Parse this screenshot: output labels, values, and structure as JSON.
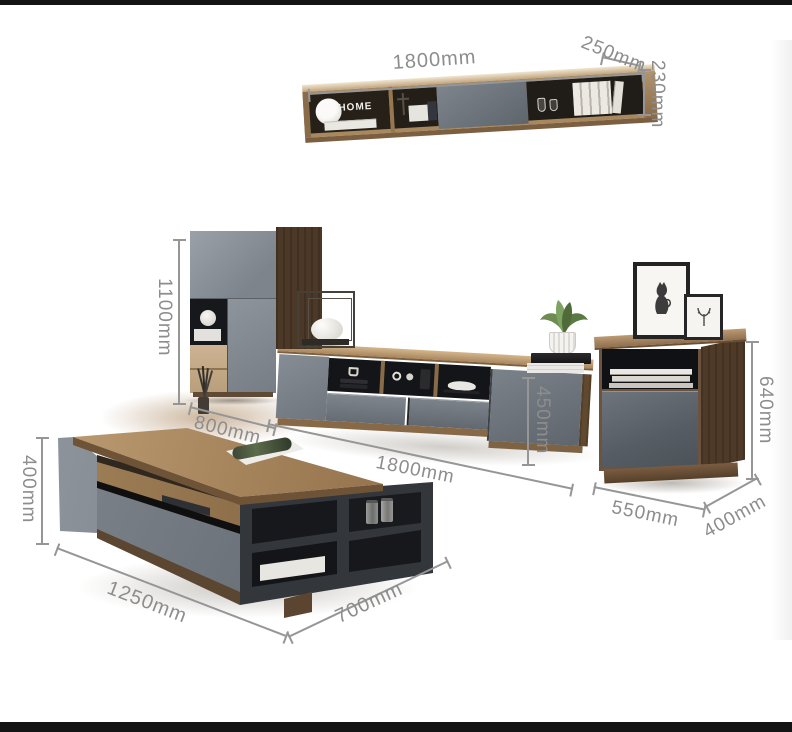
{
  "scene": {
    "description": "Living room furniture set photo with dimension annotations",
    "background": "#ffffff",
    "frame_bar_color": "#141414"
  },
  "colors": {
    "dimension_line": "#969696",
    "dimension_text": "#8d8d8d",
    "wood_light": "#c9a87f",
    "wood_dark": "#4a3526",
    "panel_gray": "#868d95",
    "charcoal": "#33373c"
  },
  "wall_shelf": {
    "width_label": "1800mm",
    "depth_label": "250mm",
    "height_label": "230mm",
    "sign_text": "HOME"
  },
  "tall_cabinet": {
    "height_label": "1100mm",
    "width_label": "800mm"
  },
  "tv_stand": {
    "width_label": "1800mm",
    "height_label": "450mm"
  },
  "side_cabinet": {
    "height_label": "640mm",
    "width_label": "550mm",
    "depth_label": "400mm"
  },
  "coffee_table": {
    "height_label": "400mm",
    "width_label": "1250mm",
    "depth_label": "700mm"
  }
}
